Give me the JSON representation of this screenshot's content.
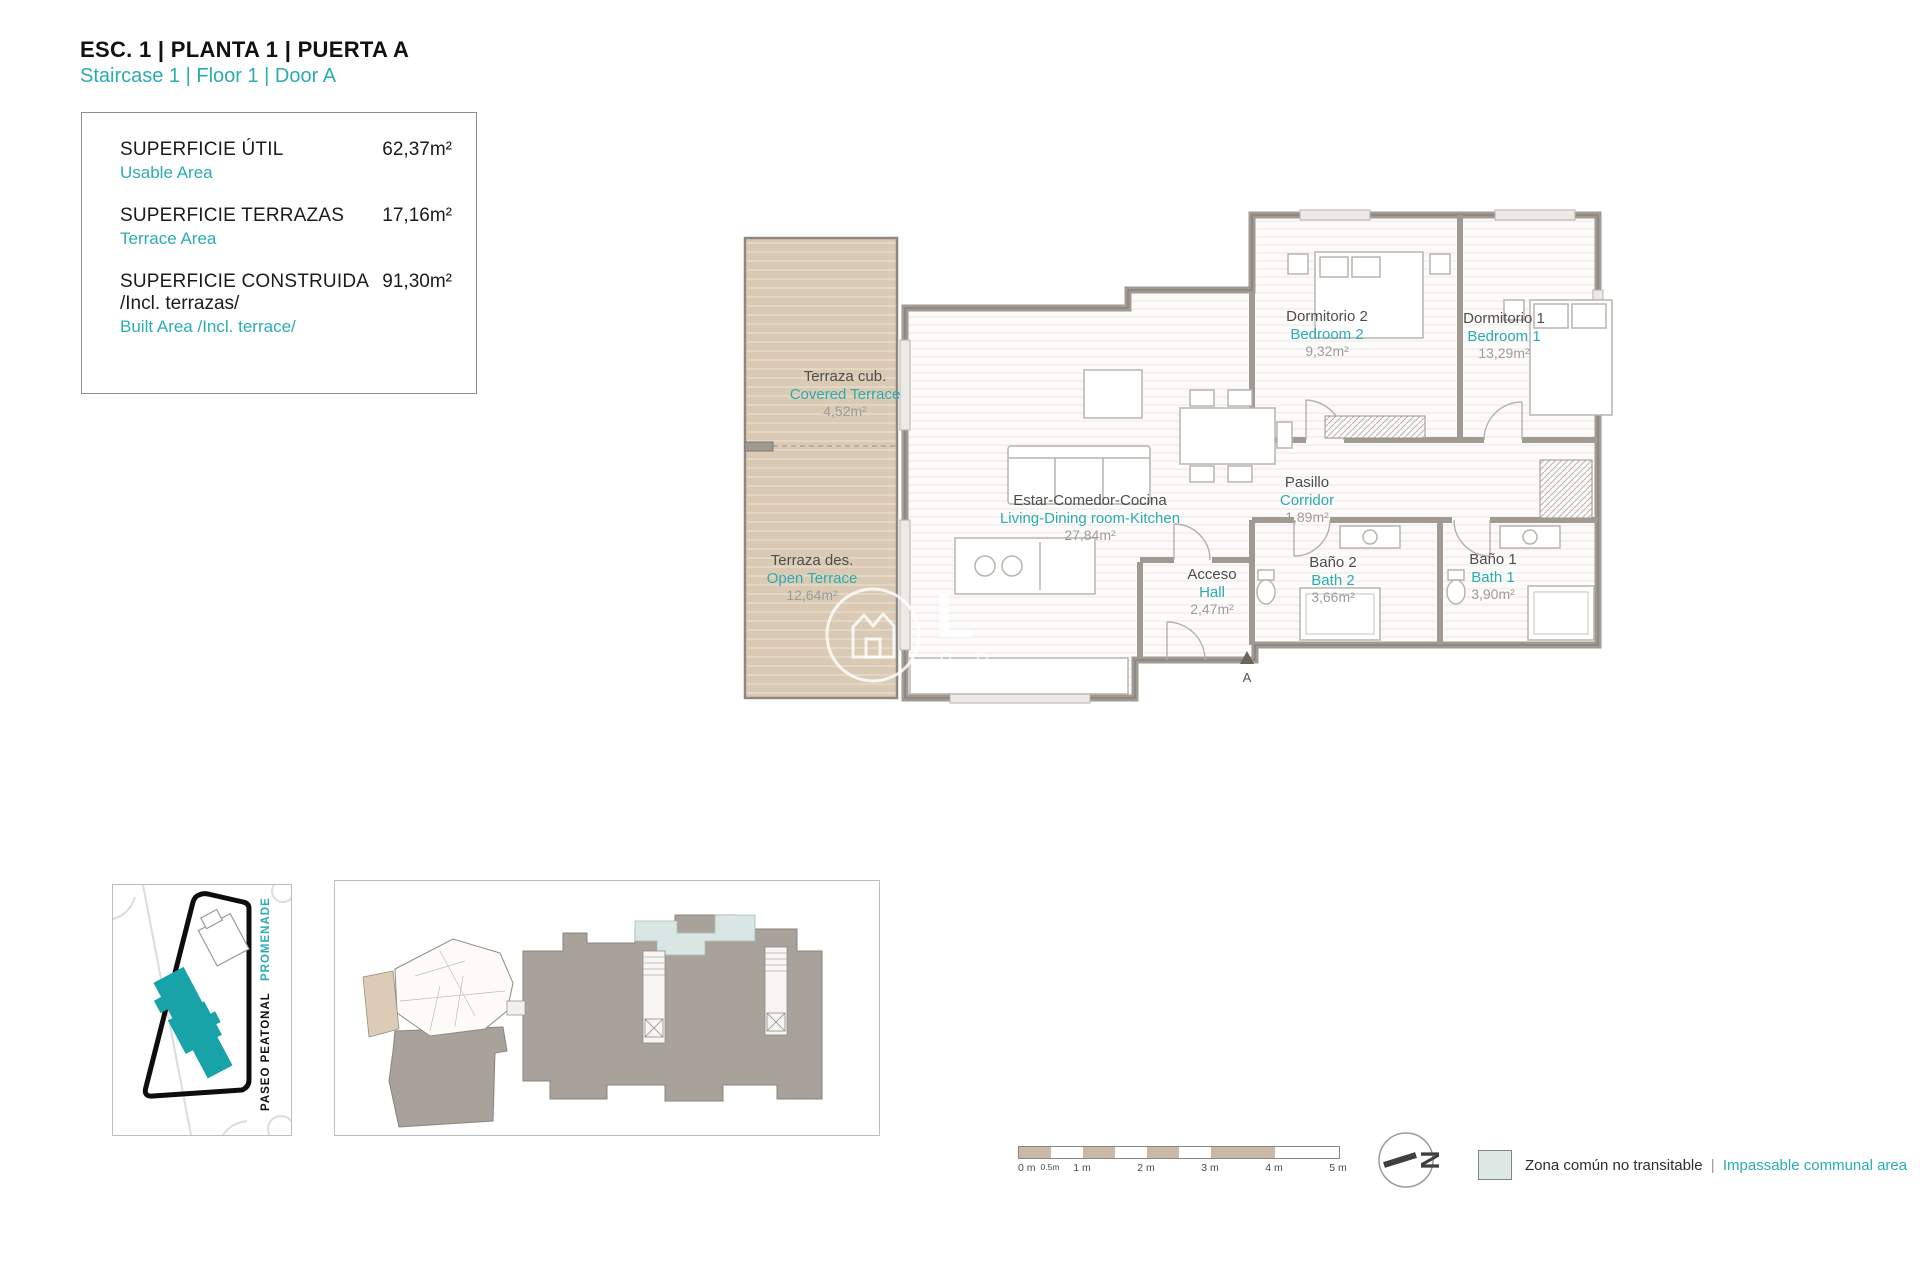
{
  "header": {
    "title_es": "ESC. 1 | PLANTA 1 | PUERTA A",
    "title_en": "Staircase 1 | Floor 1 | Door A"
  },
  "area_box": {
    "rows": [
      {
        "label_es": "SUPERFICIE ÚTIL",
        "label_en": "Usable Area",
        "value": "62,37m²"
      },
      {
        "label_es": "SUPERFICIE TERRAZAS",
        "label_en": "Terrace Area",
        "value": "17,16m²"
      },
      {
        "label_es": "SUPERFICIE CONSTRUIDA",
        "label_es2": "/Incl. terrazas/",
        "label_en": "Built Area /Incl. terrace/",
        "value": "91,30m²"
      }
    ]
  },
  "floor_plan": {
    "rooms": [
      {
        "id": "covered-terrace",
        "name_es": "Terraza cub.",
        "name_en": "Covered Terrace",
        "area": "4,52m²"
      },
      {
        "id": "open-terrace",
        "name_es": "Terraza des.",
        "name_en": "Open Terrace",
        "area": "12,64m²"
      },
      {
        "id": "living",
        "name_es": "Estar-Comedor-Cocina",
        "name_en": "Living-Dining room-Kitchen",
        "area": "27,84m²"
      },
      {
        "id": "bedroom2",
        "name_es": "Dormitorio 2",
        "name_en": "Bedroom 2",
        "area": "9,32m²"
      },
      {
        "id": "bedroom1",
        "name_es": "Dormitorio 1",
        "name_en": "Bedroom 1",
        "area": "13,29m²"
      },
      {
        "id": "corridor",
        "name_es": "Pasillo",
        "name_en": "Corridor",
        "area": "1,89m²"
      },
      {
        "id": "hall",
        "name_es": "Acceso",
        "name_en": "Hall",
        "area": "2,47m²"
      },
      {
        "id": "bath2",
        "name_es": "Baño 2",
        "name_en": "Bath 2",
        "area": "3,66m²"
      },
      {
        "id": "bath1",
        "name_es": "Baño 1",
        "name_en": "Bath 1",
        "area": "3,90m²"
      }
    ],
    "section_marker": "A"
  },
  "site_plan": {
    "street_top": "PROMENADE",
    "street_bottom": "PASEO PEATONAL"
  },
  "scale_bar": {
    "ticks": [
      "0 m",
      "0.5m",
      "1 m",
      "2 m",
      "3 m",
      "4 m",
      "5 m"
    ]
  },
  "compass": {
    "letter": "N"
  },
  "legend": {
    "label_es": "Zona común no transitable",
    "separator": "|",
    "label_en": "Impassable communal area"
  },
  "watermark": {
    "letter": "L",
    "letters_below": "P R"
  },
  "colors": {
    "accent_teal": "#2aacb2",
    "site_building_teal": "#17a3a8",
    "terrace_tan": "#dbcab3",
    "wall_gray": "#a09a93",
    "neighbor_gray": "#a9a29b",
    "highlight_blue": "#d9e6e3",
    "legend_swatch": "#dee8e5"
  }
}
